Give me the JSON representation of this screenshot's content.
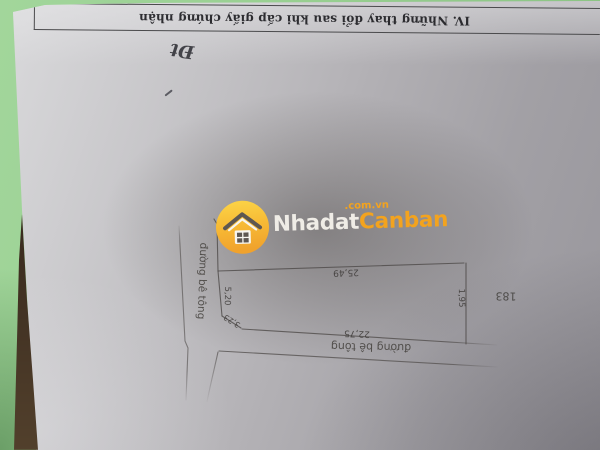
{
  "document": {
    "section_header": "IV. Những thay đổi sau khi cấp giấy chứng nhận",
    "handwritten_note": "Đt"
  },
  "watermark": {
    "brand_first": "Nhadat",
    "brand_second": "Canban",
    "domain_suffix": ".com.vn"
  },
  "diagram": {
    "parcel_number": "183",
    "road_label_vertical": "đường bê tông",
    "road_label_horizontal": "đường bê tông",
    "dimensions": {
      "top_edge": "25,49",
      "left_edge": "5,20",
      "corner_edge": "3,23",
      "bottom_edge": "22,75",
      "right_edge": "1,95"
    }
  },
  "colors": {
    "background_green": "#9ccf93",
    "brand_orange": "#f3a31e",
    "brand_yellow": "#fbd044",
    "paper_gray": "#b3b1b5",
    "shadow_brown": "#3c2d20"
  }
}
